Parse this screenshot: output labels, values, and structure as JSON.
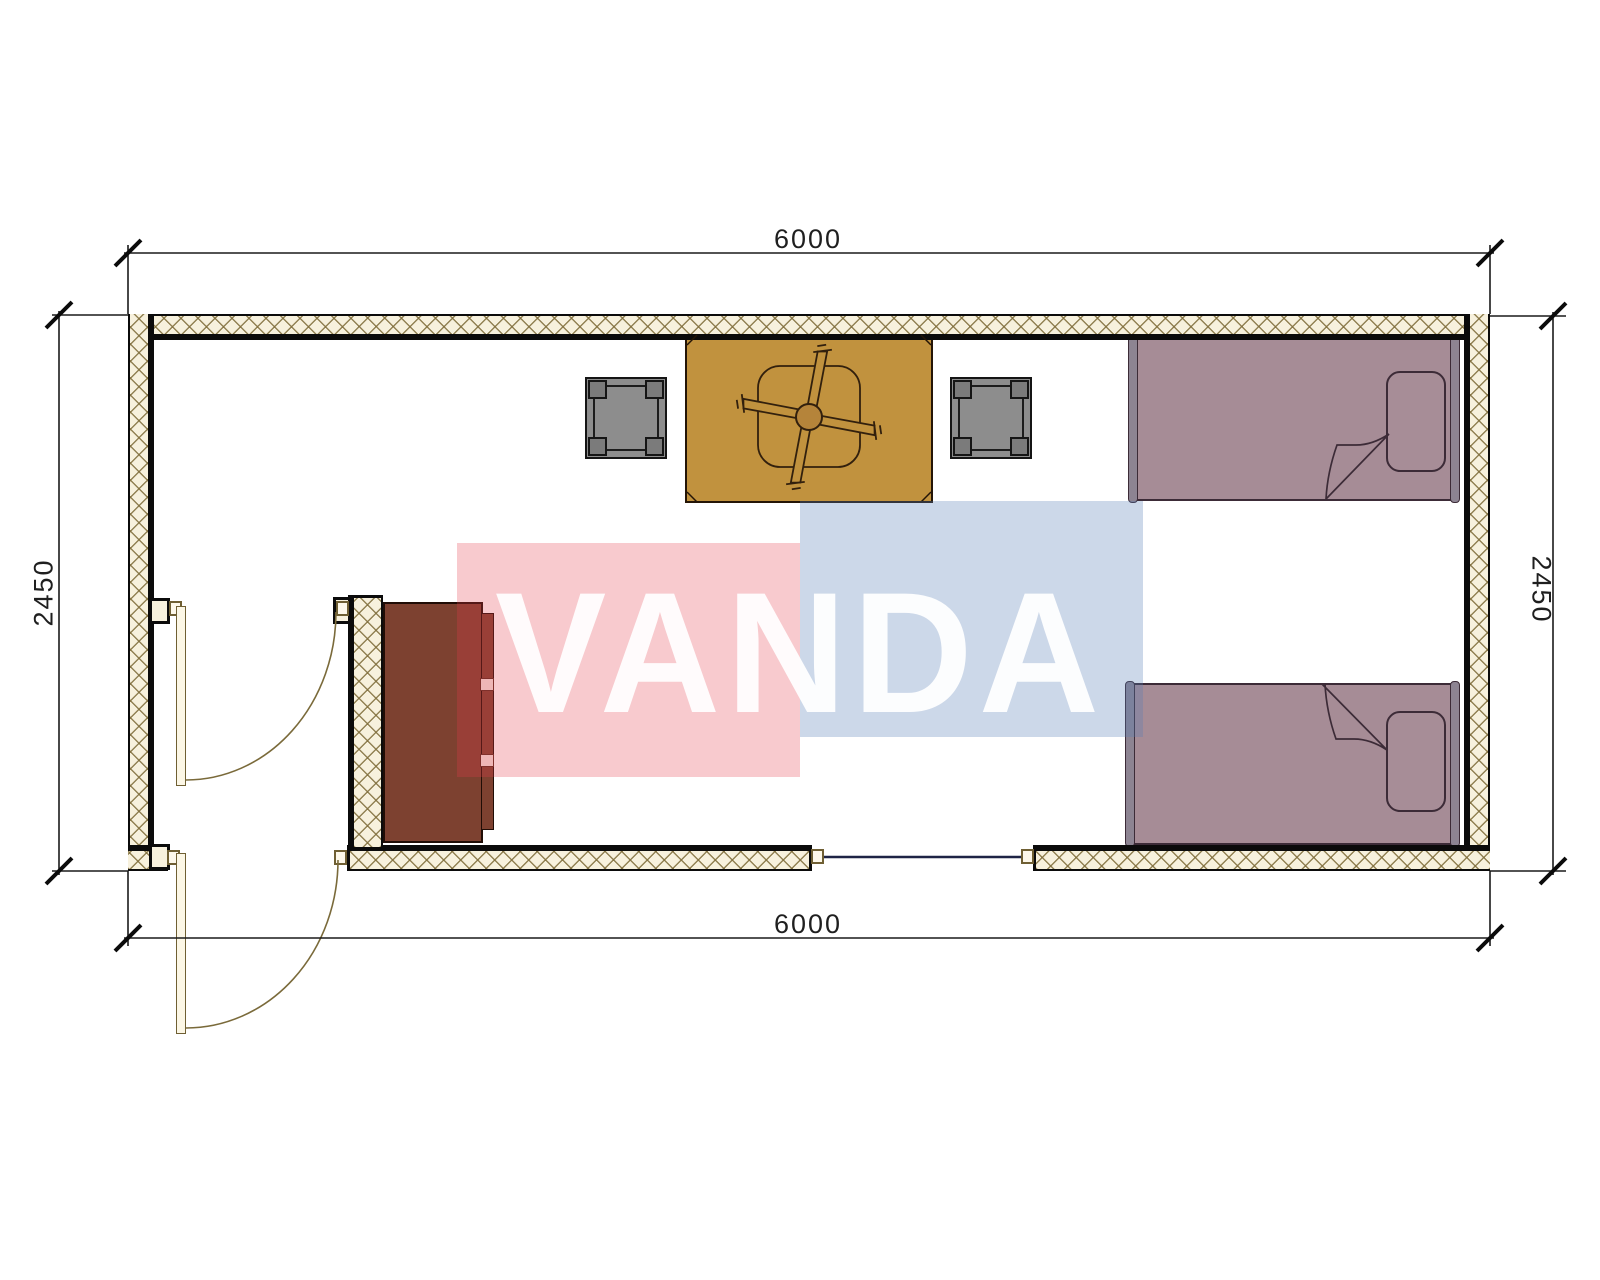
{
  "drawing": {
    "kind": "container house floor plan",
    "dims": {
      "top": "6000",
      "bottom": "6000",
      "left": "2450",
      "right": "2450"
    },
    "watermark": {
      "text": "VANDA",
      "pink_block": "#e63a4b",
      "blue_block": "#557db6",
      "text_color": "#ffffff"
    },
    "palette": {
      "wall_fill": "#f7f1dd",
      "wall_hatch": "#8a7a4a",
      "wall_line": "#0b0b0b",
      "table": "#c1923e",
      "stool": "#8d8d8d",
      "bed": "#a68c96",
      "cabinet": "#7d4130",
      "door_leaf": "#fcf7e6",
      "window_glass": "#1e2445"
    },
    "elements": [
      "exterior-walls",
      "interior-partition-wall",
      "entry-door",
      "interior-door",
      "window",
      "table-with-ceiling-fan",
      "stool-left",
      "stool-right",
      "bed-upper",
      "bed-lower",
      "cabinet"
    ]
  }
}
